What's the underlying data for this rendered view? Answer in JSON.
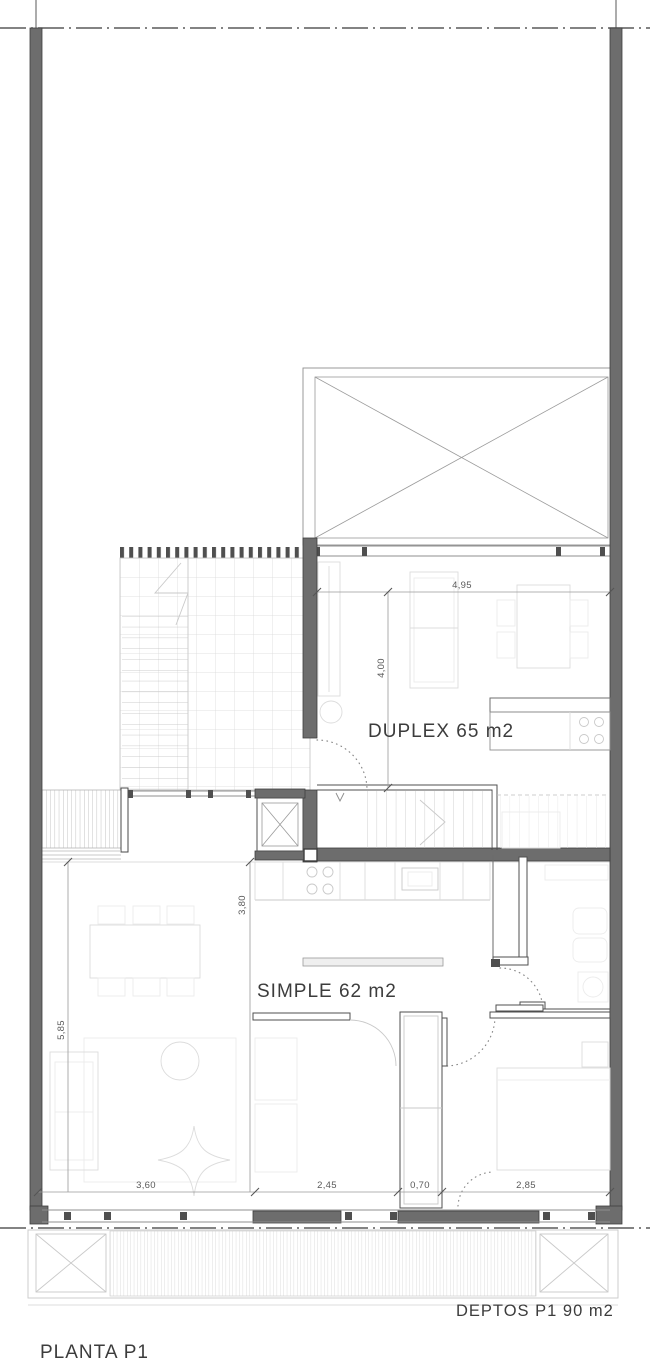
{
  "drawing": {
    "title": "PLANTA P1",
    "area_note": "DEPTOS P1 90 m2",
    "units": [
      {
        "label": "DUPLEX 65 m2"
      },
      {
        "label": "SIMPLE 62 m2"
      }
    ],
    "dimensions": {
      "duplex_width": "4,95",
      "duplex_depth": "4,00",
      "simple_depth": "3,80",
      "living_height": "5,85",
      "bottom_living": "3,60",
      "bottom_room1": "2,45",
      "bottom_closet": "0,70",
      "bottom_room2": "2,85"
    },
    "colors": {
      "wall": "#6d6d6d",
      "dark_line": "#4f4f4f",
      "furniture_line": "#dcdcdc",
      "text": "#3c3c3c",
      "background": "#ffffff"
    }
  }
}
